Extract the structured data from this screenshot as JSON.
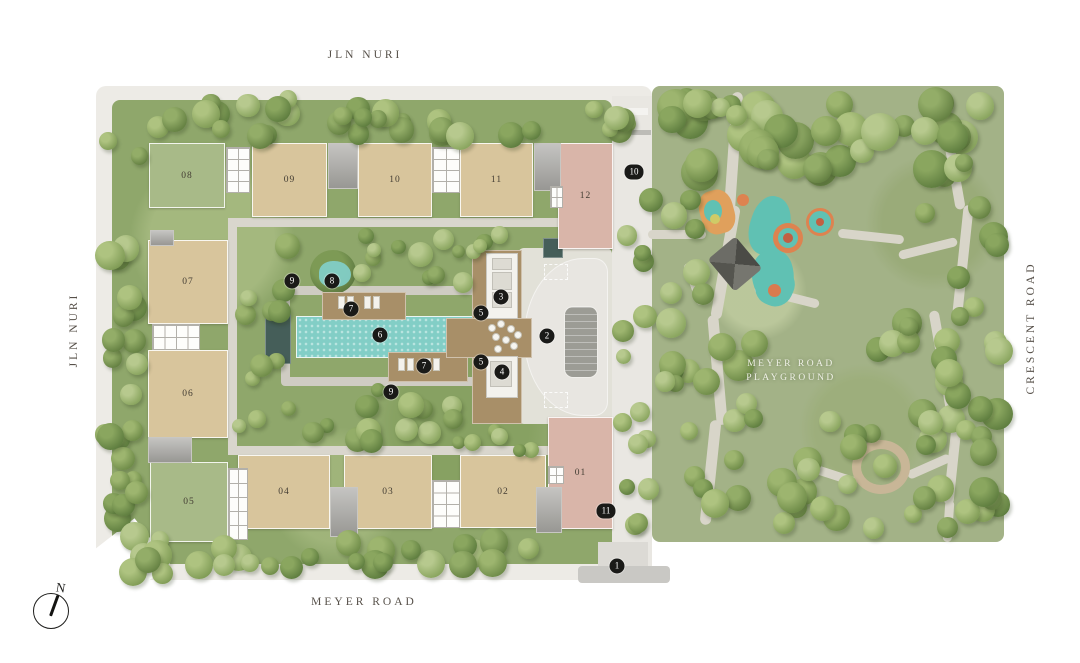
{
  "roads": {
    "top": "JLN NURI",
    "left": "JLN NURI",
    "right": "CRESCENT ROAD",
    "bottom": "MEYER ROAD"
  },
  "park": {
    "label_line1": "MEYER ROAD",
    "label_line2": "PLAYGROUND"
  },
  "compass": {
    "north_label": "N"
  },
  "buildings": [
    {
      "label": "01",
      "type": "pink"
    },
    {
      "label": "02",
      "type": "tan"
    },
    {
      "label": "03",
      "type": "tan"
    },
    {
      "label": "04",
      "type": "tan"
    },
    {
      "label": "05",
      "type": "green"
    },
    {
      "label": "06",
      "type": "tan"
    },
    {
      "label": "07",
      "type": "tan"
    },
    {
      "label": "08",
      "type": "green"
    },
    {
      "label": "09",
      "type": "tan"
    },
    {
      "label": "10",
      "type": "tan"
    },
    {
      "label": "11",
      "type": "tan"
    },
    {
      "label": "12",
      "type": "pink"
    }
  ],
  "markers": [
    {
      "label": "1"
    },
    {
      "label": "2"
    },
    {
      "label": "3"
    },
    {
      "label": "4"
    },
    {
      "label": "5"
    },
    {
      "label": "5"
    },
    {
      "label": "6"
    },
    {
      "label": "7"
    },
    {
      "label": "7"
    },
    {
      "label": "8"
    },
    {
      "label": "9"
    },
    {
      "label": "9"
    },
    {
      "label": "10"
    },
    {
      "label": "11"
    }
  ],
  "colors": {
    "pool": "#82cec6",
    "deck_wood": "#a88f68",
    "block_tan": "#d8c59c",
    "block_green": "#a8ba88",
    "block_pink": "#d9b5a9",
    "marker": "#1a1a18",
    "lawn_park": "#a3b287",
    "lawn_site": "#8fa76b",
    "path": "#d8d5c9",
    "playground_teal": "#60c1b3",
    "playground_orange": "#dd8350"
  }
}
